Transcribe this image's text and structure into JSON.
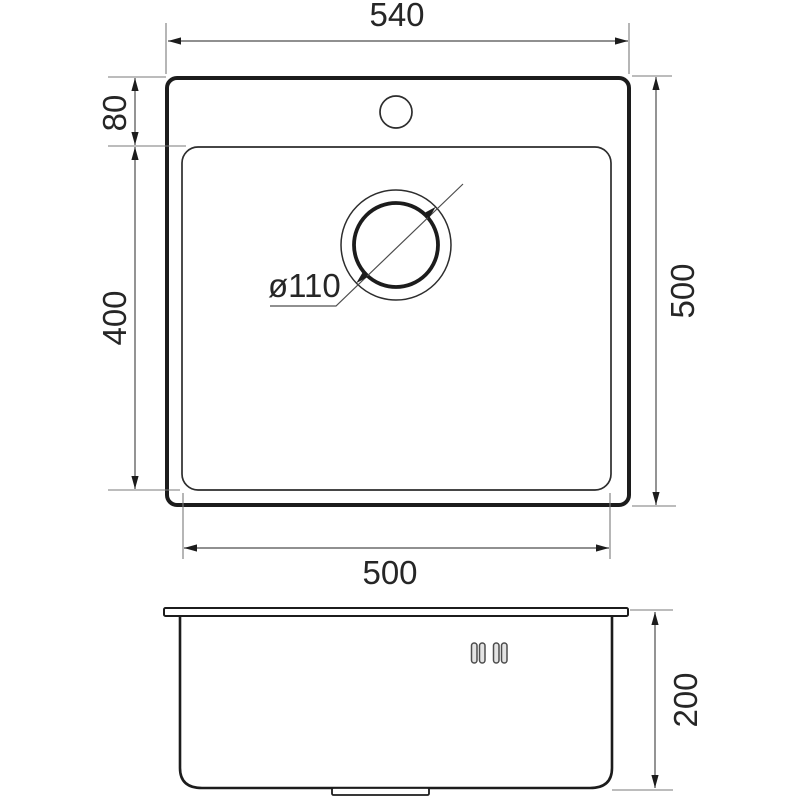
{
  "drawing": {
    "type": "technical-dimension-drawing",
    "subject": "kitchen sink, top view and front view",
    "background_color": "#ffffff",
    "line_color": "#1c1c1c",
    "dimension_line_color": "#4d4d4d",
    "dimensions": {
      "overall_width": "540",
      "overall_depth": "500",
      "faucet_offset": "80",
      "bowl_depth": "400",
      "bowl_width": "500",
      "sink_height": "200",
      "drain_diameter": "ø110"
    }
  }
}
